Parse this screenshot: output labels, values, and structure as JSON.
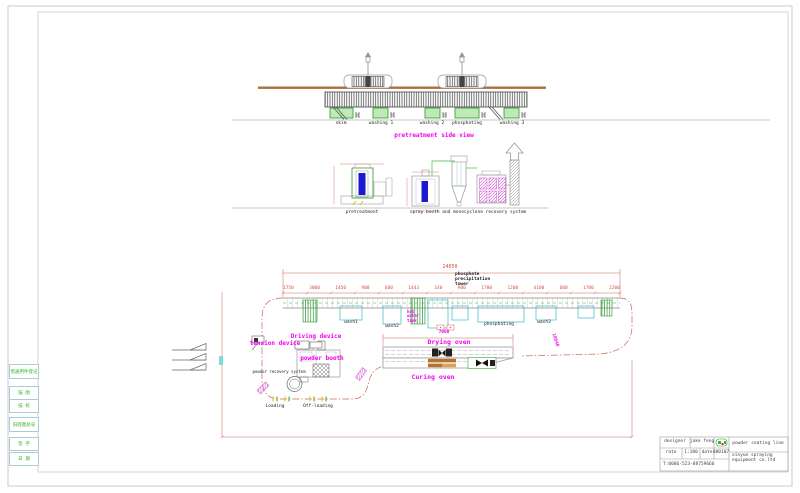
{
  "side_view": {
    "title": "pretreatment side view",
    "tank_labels": [
      "skim",
      "washing 1",
      "washing 2",
      "phosphating",
      "washing 3"
    ]
  },
  "elevation": {
    "pretreatment_label": "pretreatment",
    "spray_label": "spray booth and monocyclone recovery system"
  },
  "plan": {
    "overall_dim": "24050",
    "dims": [
      "1750",
      "3000",
      "1450",
      "900",
      "600",
      "1443",
      "140",
      "900",
      "1700",
      "1200",
      "4100",
      "600",
      "1700",
      "2200"
    ],
    "tower_note": [
      "phosphate",
      "precipitation",
      "tower"
    ],
    "driving_device": "Driving device",
    "tension_device": "tension device",
    "powder_booth": "powder booth",
    "powder_recovery": "powder recovery system",
    "drying_oven": "Drying oven",
    "drying_dim": "7000",
    "curing_oven": "Curing oven",
    "loading": "Loading",
    "off_loading": "Off-loading",
    "right_dim": "10040",
    "hot_water_tank": [
      "hot",
      "water",
      "tank"
    ],
    "tank_labels": [
      "wash1",
      "wash2",
      "phosphating",
      "wash3"
    ]
  },
  "title_block": {
    "designer_label": "designer",
    "designer_value": "jake feng",
    "rate_label": "rate",
    "rate_value": "1:100",
    "date_label": "date",
    "date_value": "080107",
    "phone": "T:0086-523-88759666",
    "project": "powder coating line",
    "company_line1": "xinyue spraying",
    "company_line2": "equipment co.ltd"
  },
  "left_strip": {
    "items": [
      "借通用件登记",
      "描 图",
      "描 校",
      "旧底图总号",
      "签 字",
      "日 期"
    ]
  },
  "colors": {
    "label_magenta": "#f202f2",
    "dimension_red": "#cc5544",
    "tank_green": "#2c9a2c",
    "track_brown": "#a9713d",
    "tank_cyan": "#3cb8c8",
    "liquid_blue": "#1a1ad0"
  }
}
